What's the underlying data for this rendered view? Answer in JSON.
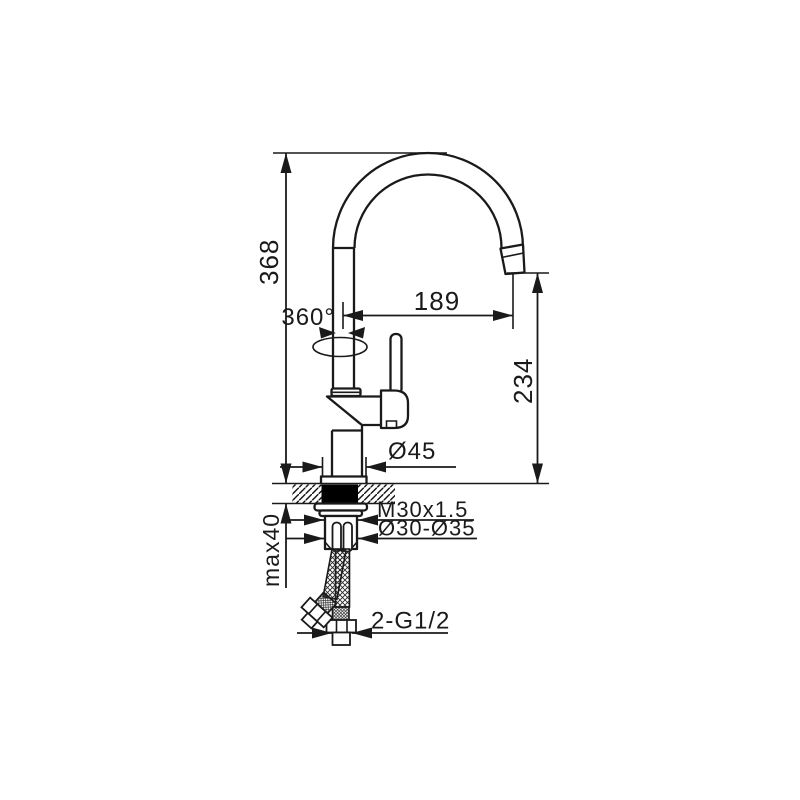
{
  "drawing": {
    "colors": {
      "line": "#1a1a1a",
      "background": "#ffffff",
      "gasket_fill": "#000000"
    },
    "labels": {
      "total_height": "368",
      "swivel_angle": "360°",
      "spout_reach": "189",
      "outlet_height": "234",
      "base_diameter": "Ø45",
      "mounting_thread": "M30x1.5",
      "hole_diameter": "Ø30-Ø35",
      "max_counter_thickness": "max40",
      "supply_connection": "2-G1/2"
    }
  }
}
